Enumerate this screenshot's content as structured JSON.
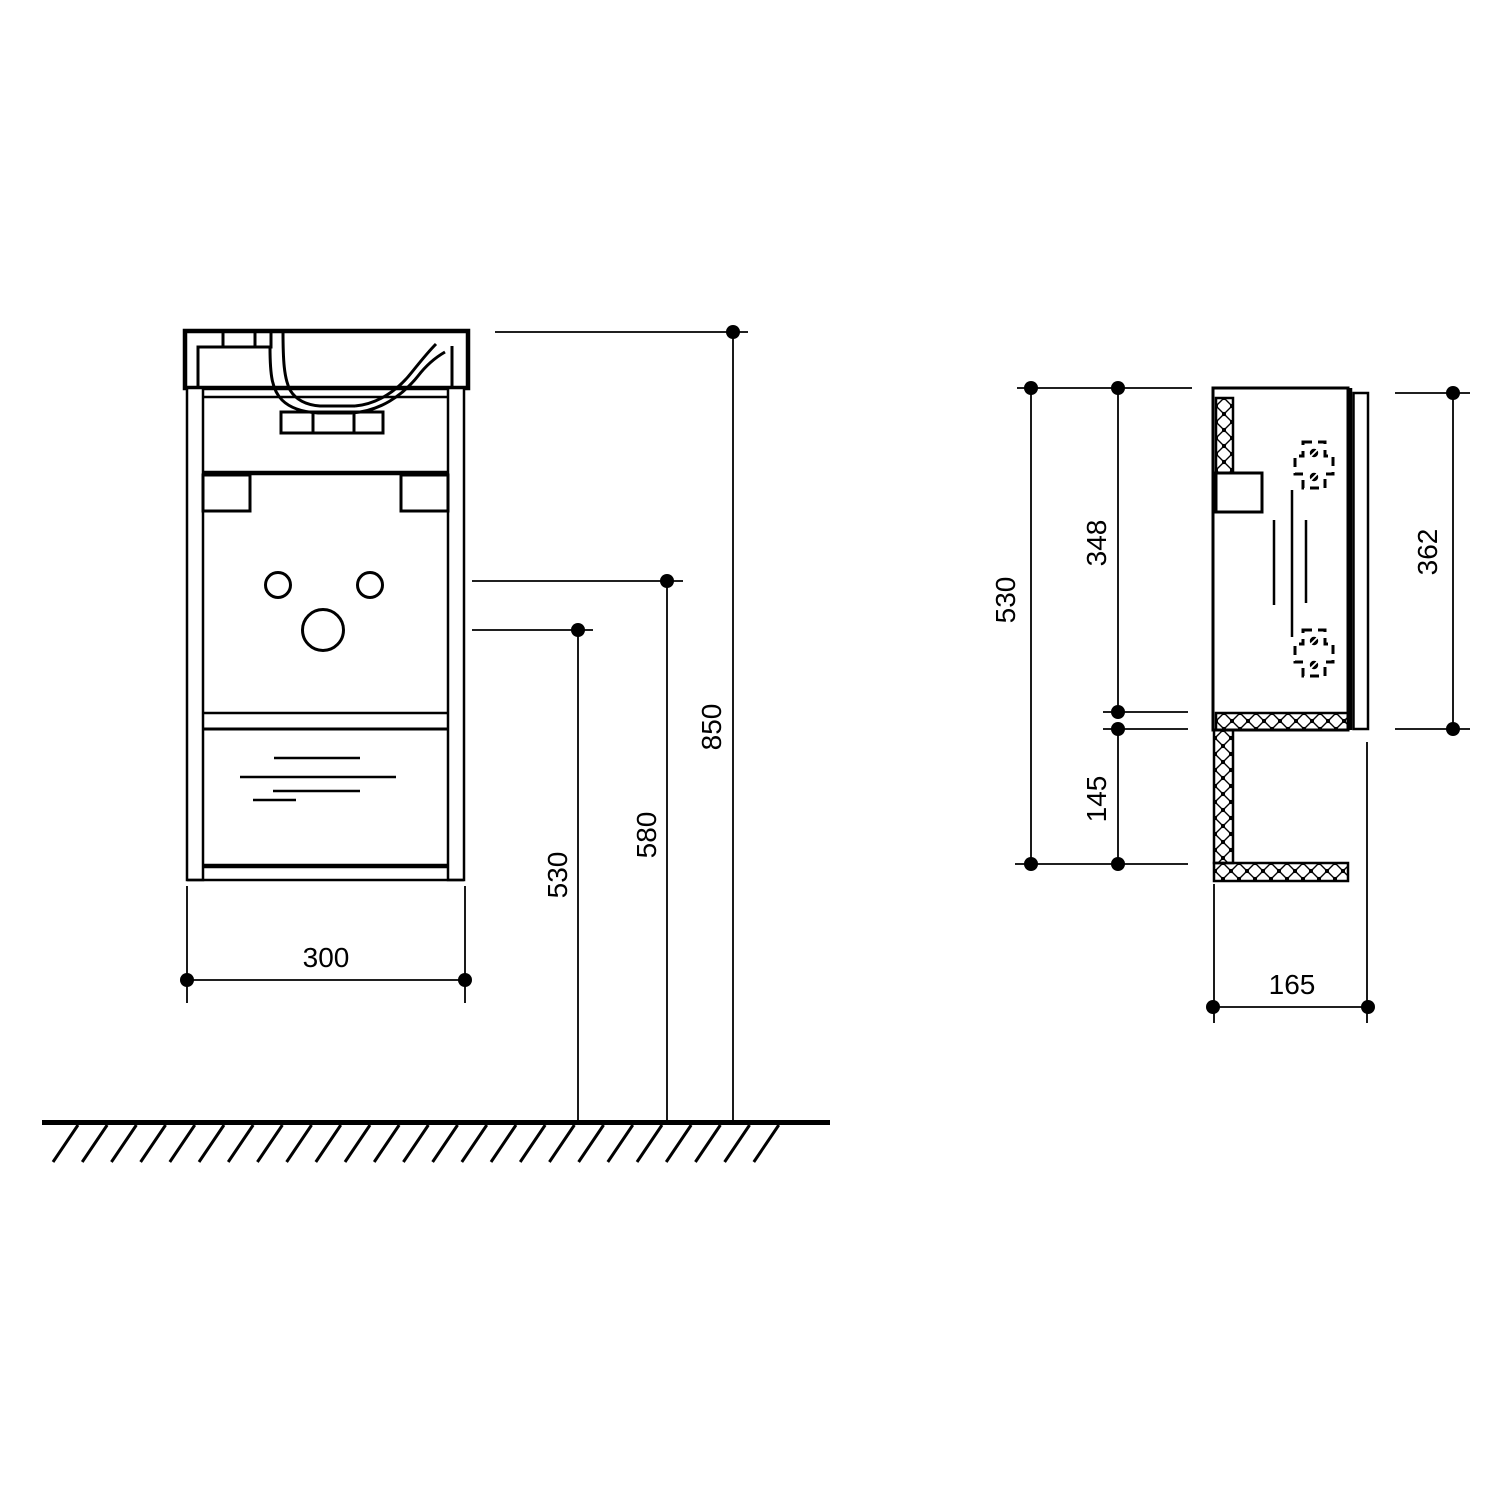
{
  "colors": {
    "background": "#ffffff",
    "ink": "#000000"
  },
  "front_view": {
    "dim_width": "300",
    "dim_height_530": "530",
    "dim_height_580": "580",
    "dim_height_850": "850"
  },
  "side_view": {
    "dim_height_530": "530",
    "dim_inner_348": "348",
    "dim_lower_145": "145",
    "dim_door_362": "362",
    "dim_depth_165": "165"
  }
}
